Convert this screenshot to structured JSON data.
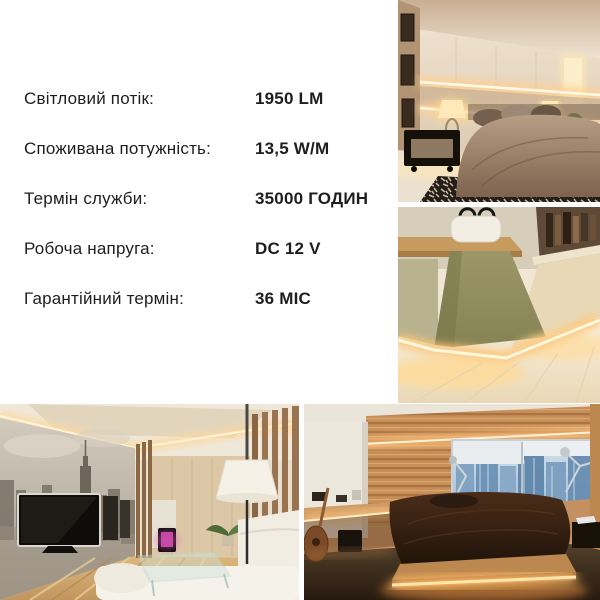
{
  "page": {
    "background": "#ffffff",
    "text_color": "#1e1e1e",
    "led_glow_color": "#ffd9a0"
  },
  "specs": {
    "rows": [
      {
        "label": "Світловий потік:",
        "value": "1950 LM"
      },
      {
        "label": "Споживана потужність:",
        "value": "13,5 W/M"
      },
      {
        "label": "Термін служби:",
        "value": "35000 ГОДИН"
      },
      {
        "label": "Робоча напруга:",
        "value": "DC 12 V"
      },
      {
        "label": "Гарантійний термін:",
        "value": "36 МІС"
      }
    ]
  },
  "photos": [
    {
      "id": "bedroom-backlit-wall",
      "description": "Bedroom with warm LED strips glowing in wall niches above the bed"
    },
    {
      "id": "baseboard-led-closet",
      "description": "Closet corner with LED strip set into the skirting board, olive walls"
    },
    {
      "id": "living-room-cove-ceiling",
      "description": "Living room with LED cove ceiling light, NYC mural, TV and white sofa"
    },
    {
      "id": "platform-bed-underglow",
      "description": "Bedroom with platform bed under-lit by LED strip, city window view"
    }
  ]
}
